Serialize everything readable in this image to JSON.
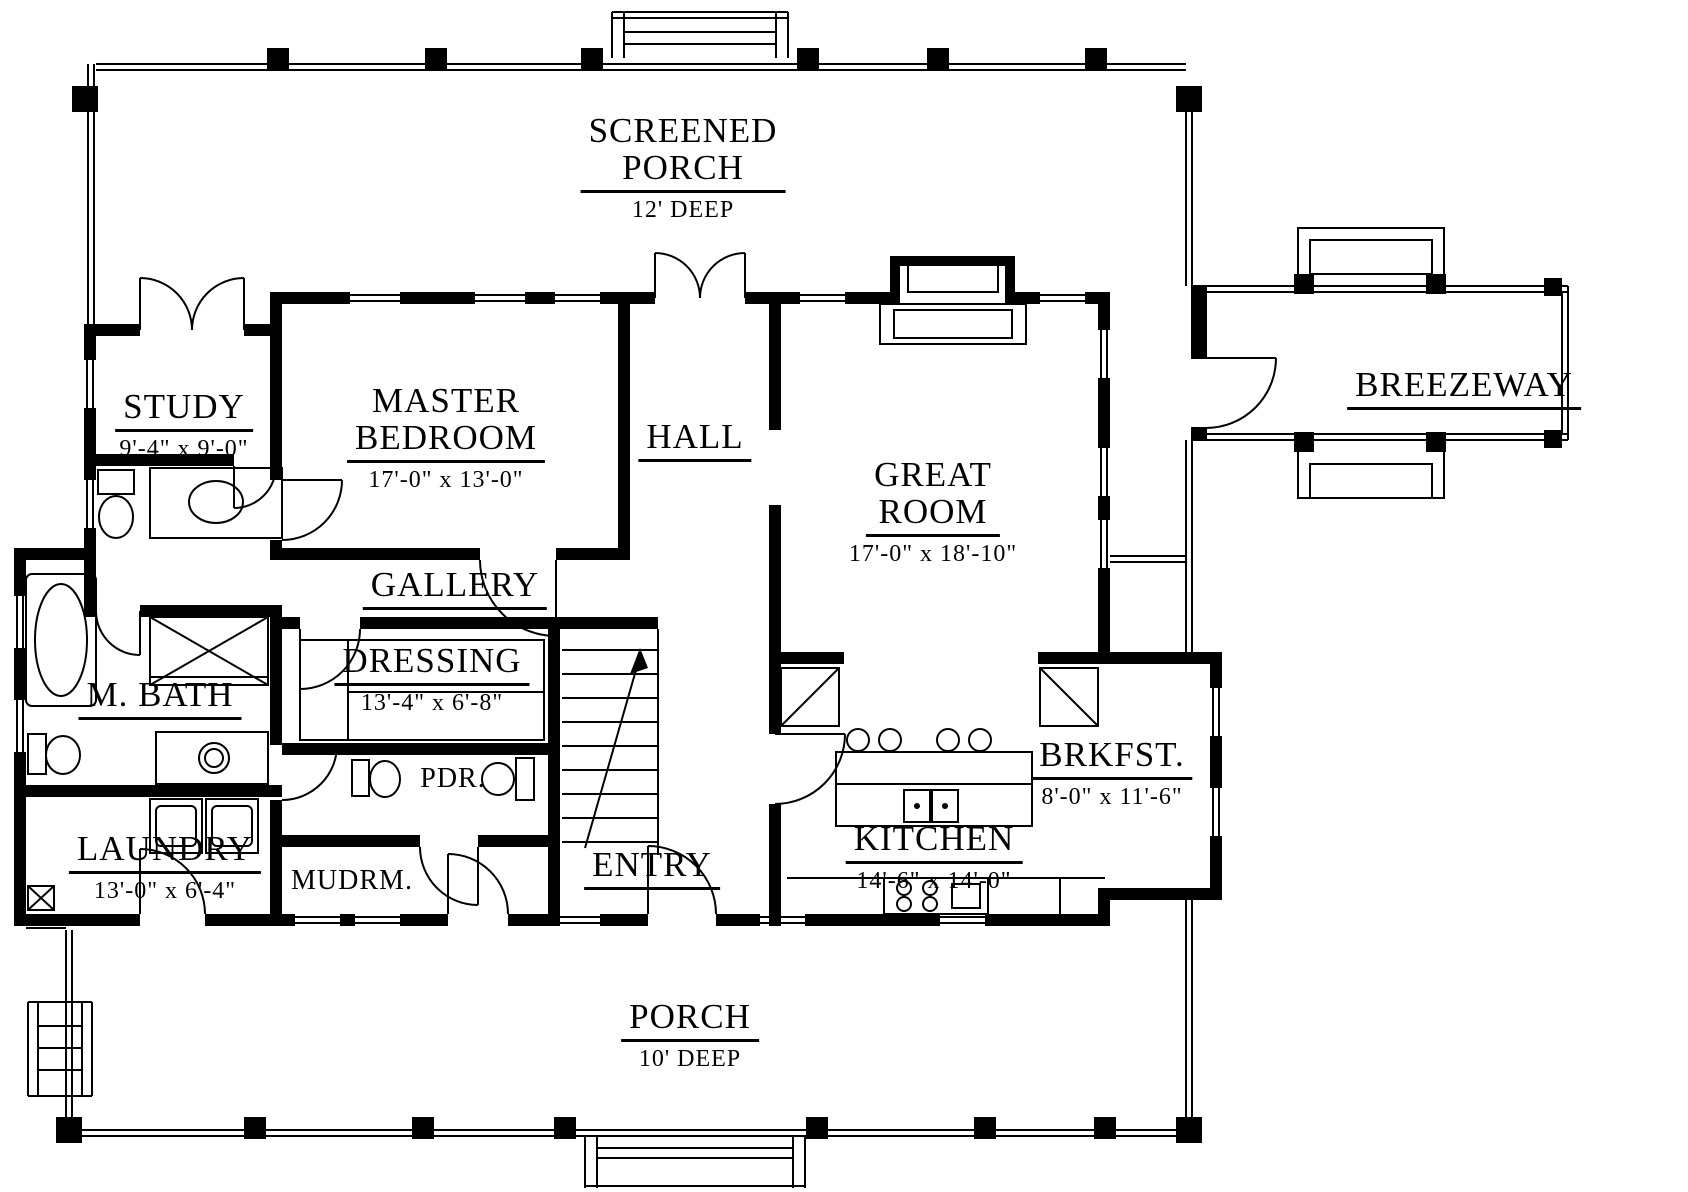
{
  "style": {
    "line_color": "#000000",
    "background_color": "#ffffff"
  },
  "rooms": {
    "screened_porch": {
      "line1": "SCREENED",
      "line2": "PORCH",
      "dims": "12' DEEP"
    },
    "study": {
      "name": "STUDY",
      "dims": "9'-4\" x 9'-0\""
    },
    "master_bedroom": {
      "line1": "MASTER",
      "line2": "BEDROOM",
      "dims": "17'-0\" x 13'-0\""
    },
    "hall": {
      "name": "HALL"
    },
    "great_room": {
      "line1": "GREAT",
      "line2": "ROOM",
      "dims": "17'-0\" x 18'-10\""
    },
    "breezeway": {
      "name": "BREEZEWAY"
    },
    "gallery": {
      "name": "GALLERY"
    },
    "dressing": {
      "name": "DRESSING",
      "dims": "13'-4\" x 6'-8\""
    },
    "m_bath": {
      "name": "M. BATH"
    },
    "pdr": {
      "name": "PDR."
    },
    "laundry": {
      "name": "LAUNDRY",
      "dims": "13'-0\" x 6'-4\""
    },
    "mudrm": {
      "name": "MUDRM."
    },
    "entry": {
      "name": "ENTRY"
    },
    "brkfst": {
      "name": "BRKFST.",
      "dims": "8'-0\" x 11'-6\""
    },
    "kitchen": {
      "name": "KITCHEN",
      "dims": "14'-6\" x 14'-0\""
    },
    "porch": {
      "line1": "PORCH",
      "dims": "10' DEEP"
    }
  }
}
